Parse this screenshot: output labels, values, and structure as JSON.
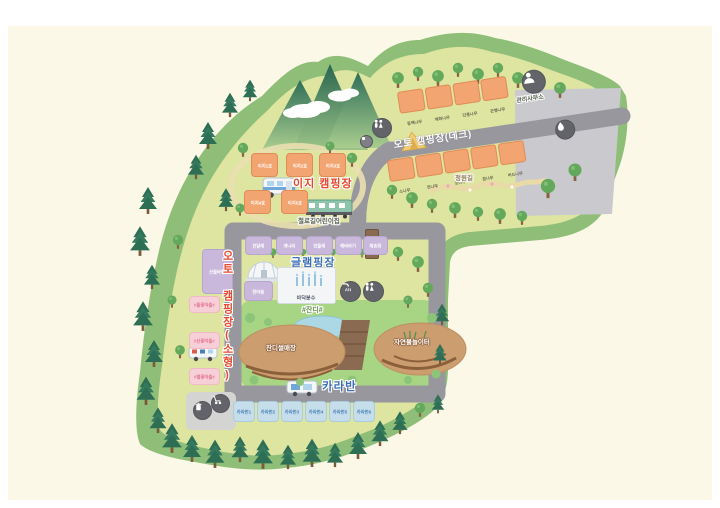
{
  "easy_camping": {
    "title": "이지 캠핑장",
    "sites": [
      "이지1호",
      "이지2호",
      "이지3호",
      "이지4호",
      "이지5호"
    ],
    "train_label": "철로길어린이집"
  },
  "auto_deck": {
    "road_label": "오토 캠핑장(데크)",
    "upper_sites": [
      "동백나무",
      "매화나무",
      "단풍나무",
      "은행나무"
    ],
    "lower_sites": [
      "소나무",
      "전나무",
      "잣나무",
      "참나무",
      "버드나무"
    ],
    "office_label": "관리사무소",
    "path_label": "정원길"
  },
  "glamping": {
    "title": "글램핑장",
    "sites": [
      "진달래",
      "개나리",
      "민들레",
      "해바라기",
      "채송화"
    ],
    "hall_label": "산들바람",
    "annex_label": "한마음",
    "fountain_label": "바닥분수"
  },
  "auto_small": {
    "road_label": "오토 캠핑장(소형)",
    "sites": [
      "#들꽃마을#",
      "#산꽃마을#",
      "#별꽃마을#"
    ]
  },
  "caravan": {
    "title": "카라반",
    "sites": [
      "카라반1",
      "카라반2",
      "카라반3",
      "카라반4",
      "카라반5",
      "카라반6"
    ]
  },
  "park": {
    "lawn_label": "#잔디#",
    "sled_label": "잔디썰매장",
    "play_label": "자연물놀이터"
  },
  "signs": {
    "junction_sign": "매점"
  },
  "colors": {
    "road": "#97979D",
    "accent_red": "#E8462E",
    "accent_blue": "#3D6FB5",
    "field": "#DDE5A1",
    "forest": "#8FBE78"
  }
}
